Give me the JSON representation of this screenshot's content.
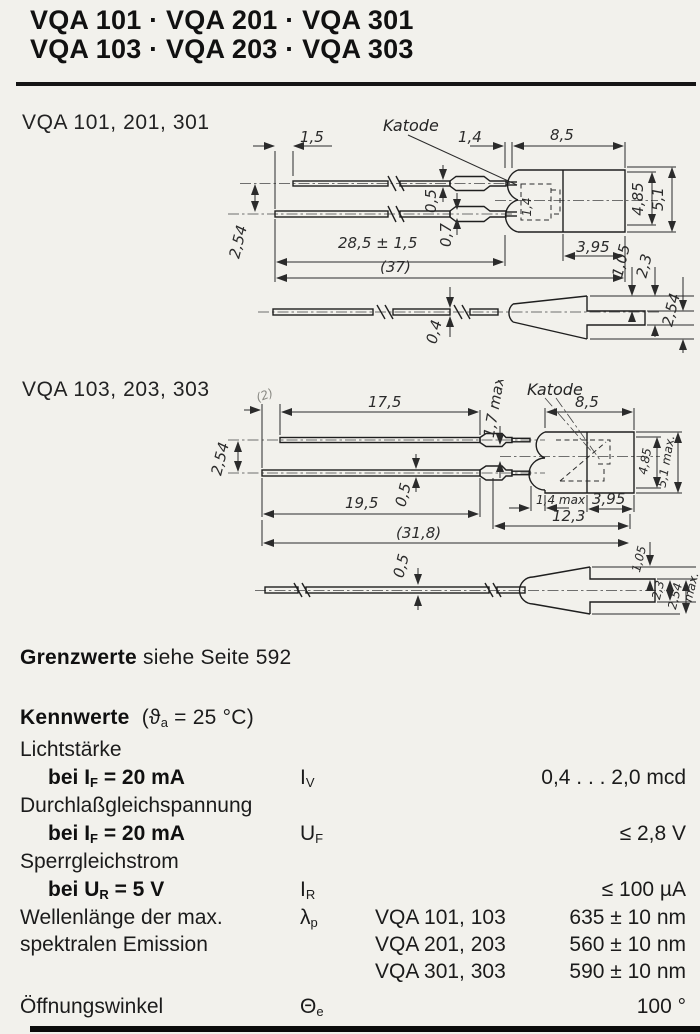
{
  "title": {
    "line1": "VQA 101 · VQA 201 · VQA 301",
    "line2": "VQA 103 · VQA 203 · VQA 303"
  },
  "sections": {
    "d1_label": "VQA 101, 201, 301",
    "d2_label": "VQA 103, 203, 303"
  },
  "drawing1": {
    "katode": "Katode",
    "dim_1_5": "1,5",
    "dim_1_4_top": "1,4",
    "dim_8_5": "8,5",
    "dim_0_5": "0,5",
    "dim_0_7": "0,7",
    "dim_28_5": "28,5 ± 1,5",
    "dim_37": "(37)",
    "dim_3_95": "3,95",
    "dim_4_85": "4,85",
    "dim_5_1": "5,1",
    "dim_2_54_left": "2,54",
    "dim_1_4_inner": "1,4",
    "dim_1_05": "1,05",
    "dim_2_3": "2,3",
    "dim_2_54_right": "2,54",
    "dim_0_4": "0,4"
  },
  "drawing2": {
    "katode": "Katode",
    "dim_2": "(2)",
    "dim_17_5": "17,5",
    "dim_1_7": "1,7 max",
    "dim_8_5": "8,5",
    "dim_2_54_left": "2,54",
    "dim_0_5_top": "0,5",
    "dim_19_5": "19,5",
    "dim_1_4": "1,4 max",
    "dim_3_95": "3,95",
    "dim_12_3": "12,3",
    "dim_31_8": "(31,8)",
    "dim_4_85": "4,85",
    "dim_5_1": "5,1 max.",
    "dim_0_5_side": "0,5",
    "dim_1_05": "1,05",
    "dim_2_3": "2,3",
    "dim_2_54_side": "2,54",
    "dim_max": "max."
  },
  "grenzwerte": {
    "bold": "Grenzwerte",
    "rest": " siehe Seite 592"
  },
  "kennwerte": {
    "heading": "Kennwerte",
    "cond_open": "(ϑ",
    "cond_sub": "a",
    "cond_rest": " = 25 °C)",
    "rows": {
      "lichtstaerke": "Lichtstärke",
      "r1_pre": "bei ",
      "r1_sym": "I",
      "r1_sub": "F",
      "r1_post": " = 20 mA",
      "r1_qty": "I",
      "r1_qty_sub": "V",
      "r1_val": "0,4 . . . 2,0 mcd",
      "durchlass": "Durchlaßgleichspannung",
      "r2_pre": "bei ",
      "r2_sym": "I",
      "r2_sub": "F",
      "r2_post": " = 20 mA",
      "r2_qty": "U",
      "r2_qty_sub": "F",
      "r2_val": "≤ 2,8 V",
      "sperr": "Sperrgleichstrom",
      "r3_pre": "bei ",
      "r3_sym": "U",
      "r3_sub": "R",
      "r3_post": " = 5 V",
      "r3_qty": "I",
      "r3_qty_sub": "R",
      "r3_val": "≤ 100 µA",
      "wellen1": "Wellenlänge der max.",
      "wellen2": "spektralen Emission",
      "r4_qty": "λ",
      "r4_qty_sub": "p",
      "r4_variants": [
        {
          "name": "VQA 101, 103",
          "value": "635 ± 10 nm"
        },
        {
          "name": "VQA 201, 203",
          "value": "560 ± 10 nm"
        },
        {
          "name": "VQA 301, 303",
          "value": "590 ± 10 nm"
        }
      ],
      "oeffnung": "Öffnungswinkel",
      "r5_qty": "Θ",
      "r5_qty_sub": "e",
      "r5_val": "100 °"
    }
  }
}
